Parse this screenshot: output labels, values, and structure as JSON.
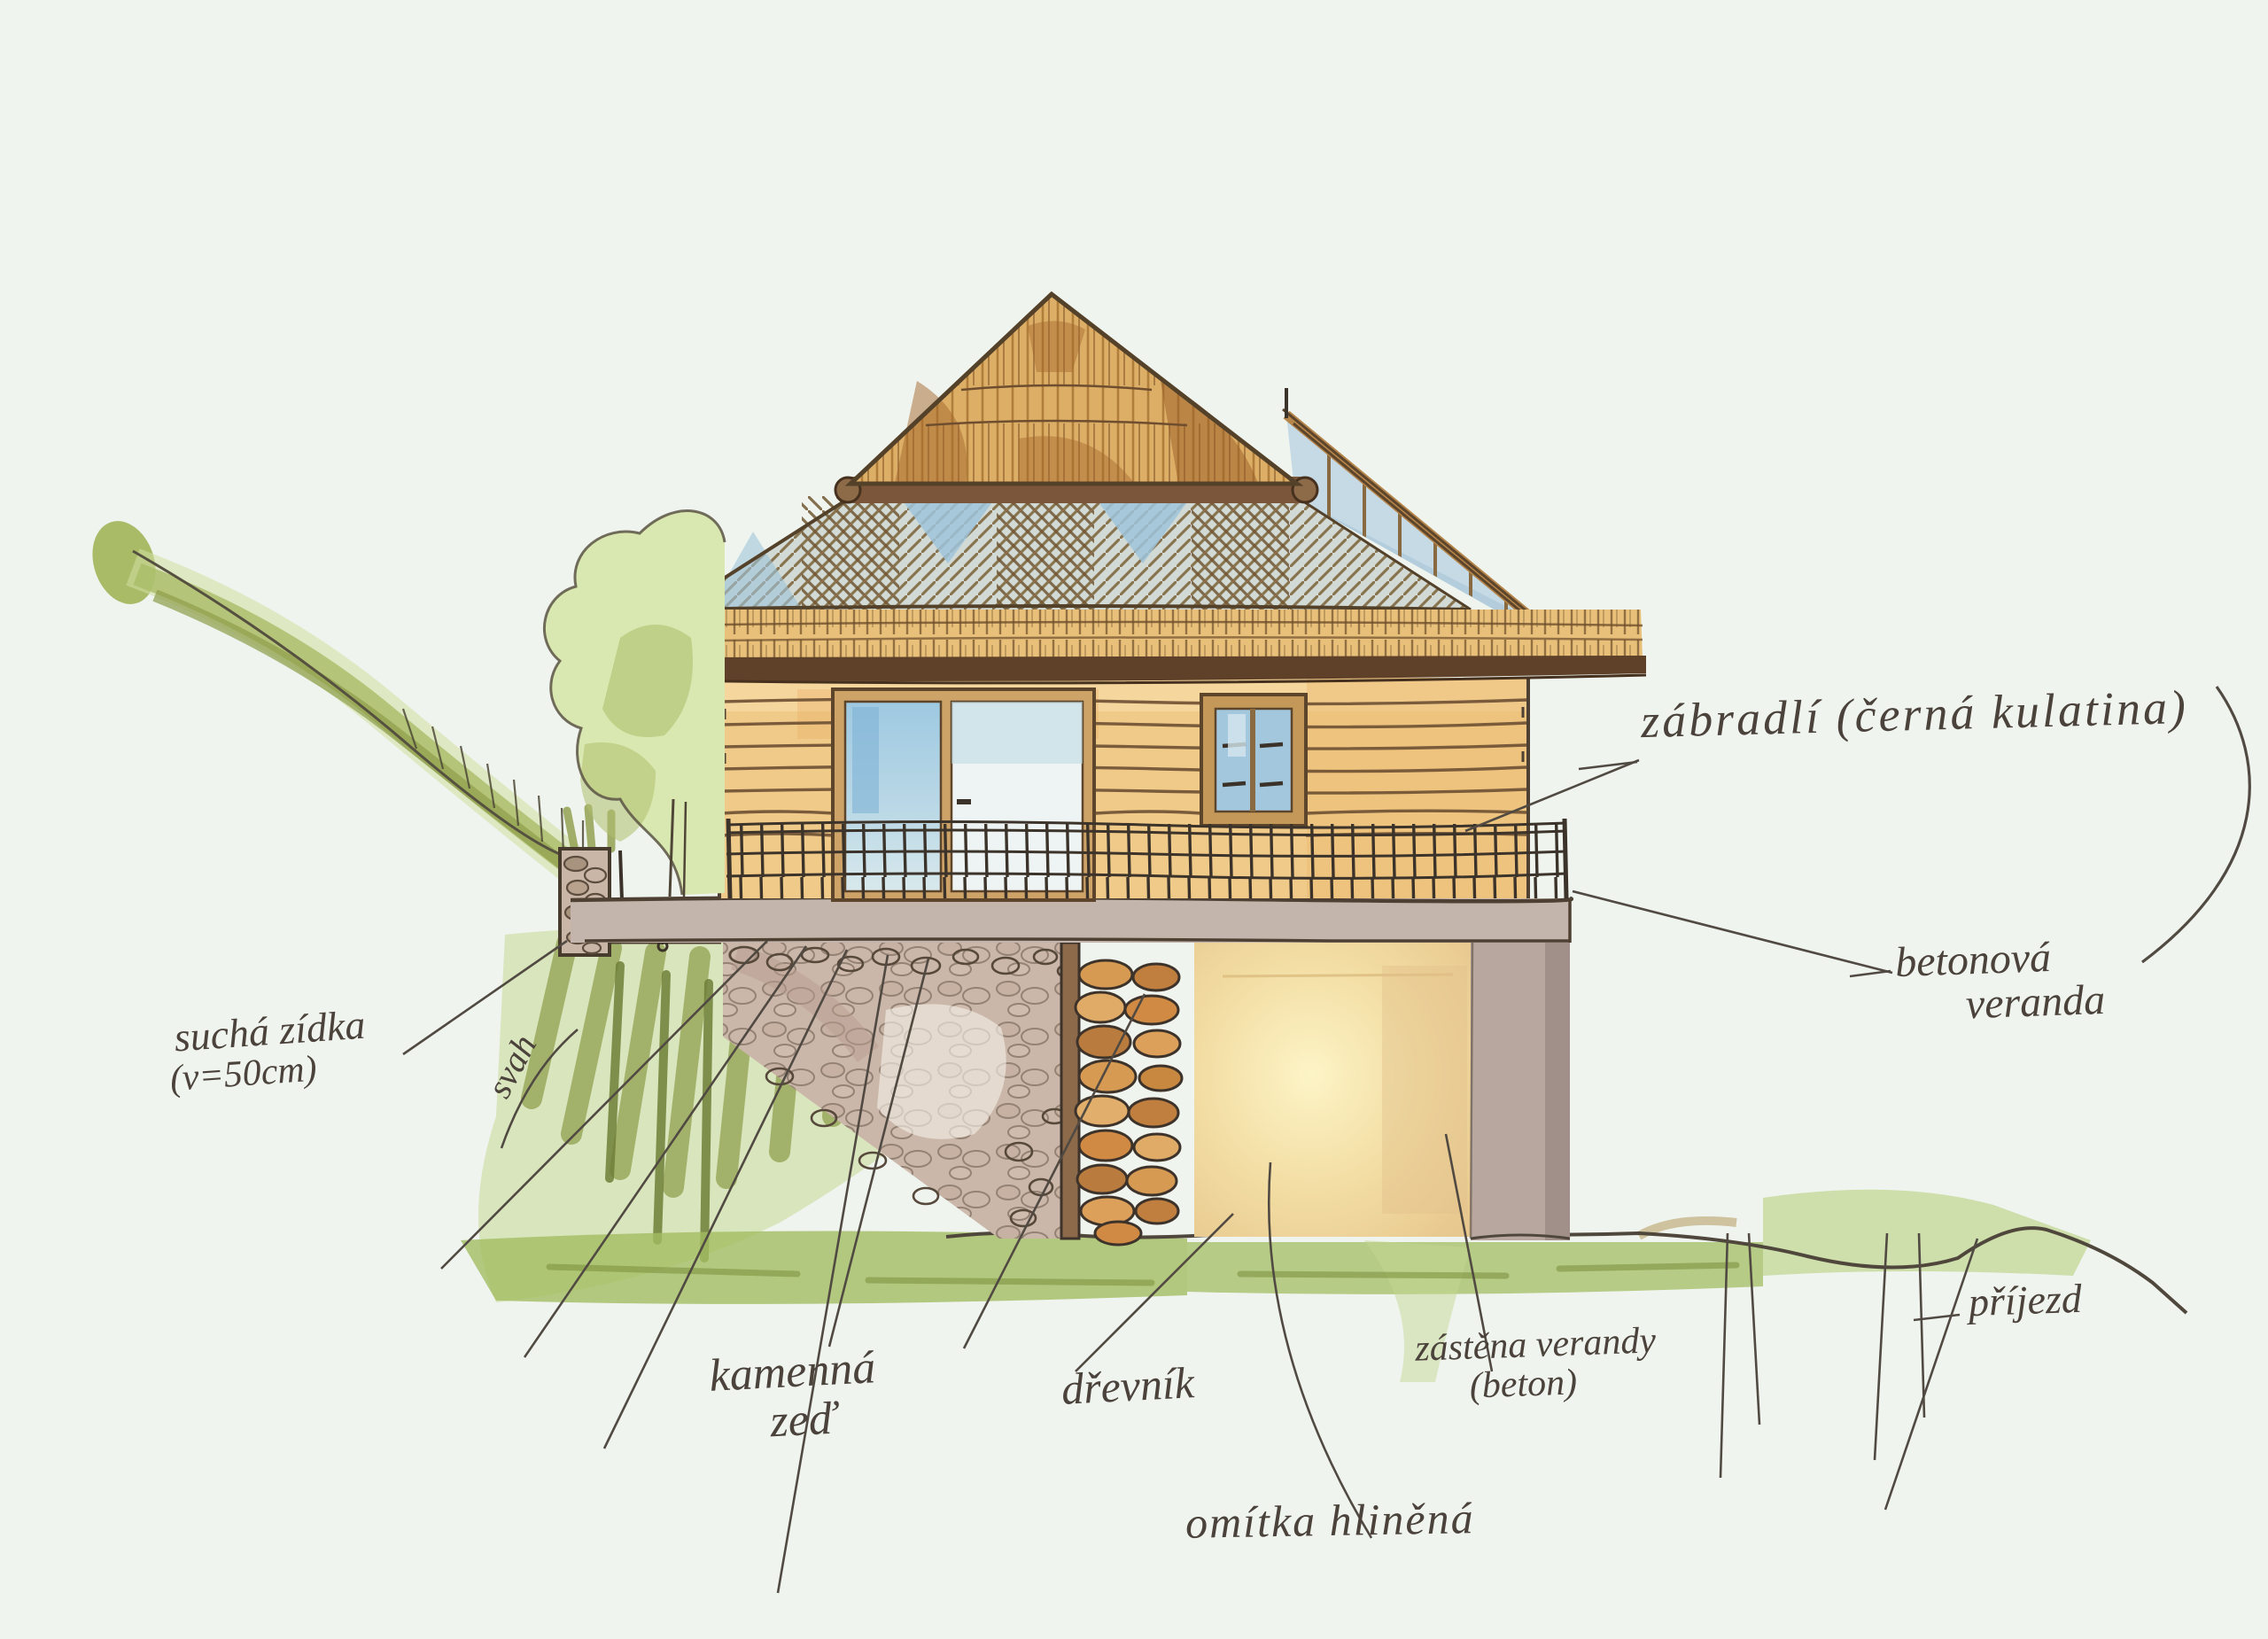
{
  "document": {
    "title": "Hand-drawn ink and watercolor sketch – cottage side elevation with construction notes",
    "language": "Czech"
  },
  "colors": {
    "paper": "#eff4ee",
    "ink": "#4b433b",
    "wall_wood": "#f0ca88",
    "roof_gable": "#dcae66",
    "roof_fascia": "#5f4129",
    "beam_brown": "#7b563a",
    "glass_blue": "#a9cde2",
    "slab_grey": "#c3b5ab",
    "stone_wash": "#cbb7aa",
    "clay_glow": "#fdf2c2",
    "concrete_grey": "#b7a79f",
    "log_wood": "#d69a52",
    "green_light": "#cfe0a0",
    "green_mid": "#a9bb66",
    "green_dark": "#8d9d4a"
  },
  "annotations": {
    "zabradli": {
      "label": "zábradlí (černá kulatina)"
    },
    "betonova_veranda": {
      "line1": "betonová",
      "line2": "veranda"
    },
    "sucha_zidka": {
      "line1": "suchá zídka",
      "line2": "(v=50cm)"
    },
    "svah": {
      "label": "svah"
    },
    "kamenna_zed": {
      "line1": "kamenná",
      "line2": "zeď"
    },
    "drevnik": {
      "label": "dřevník"
    },
    "zastena_verandy": {
      "line1": "zástěna verandy",
      "line2": "(beton)"
    },
    "omitka": {
      "label": "omítka hliněná"
    },
    "prijezd": {
      "label": "příjezd"
    }
  }
}
